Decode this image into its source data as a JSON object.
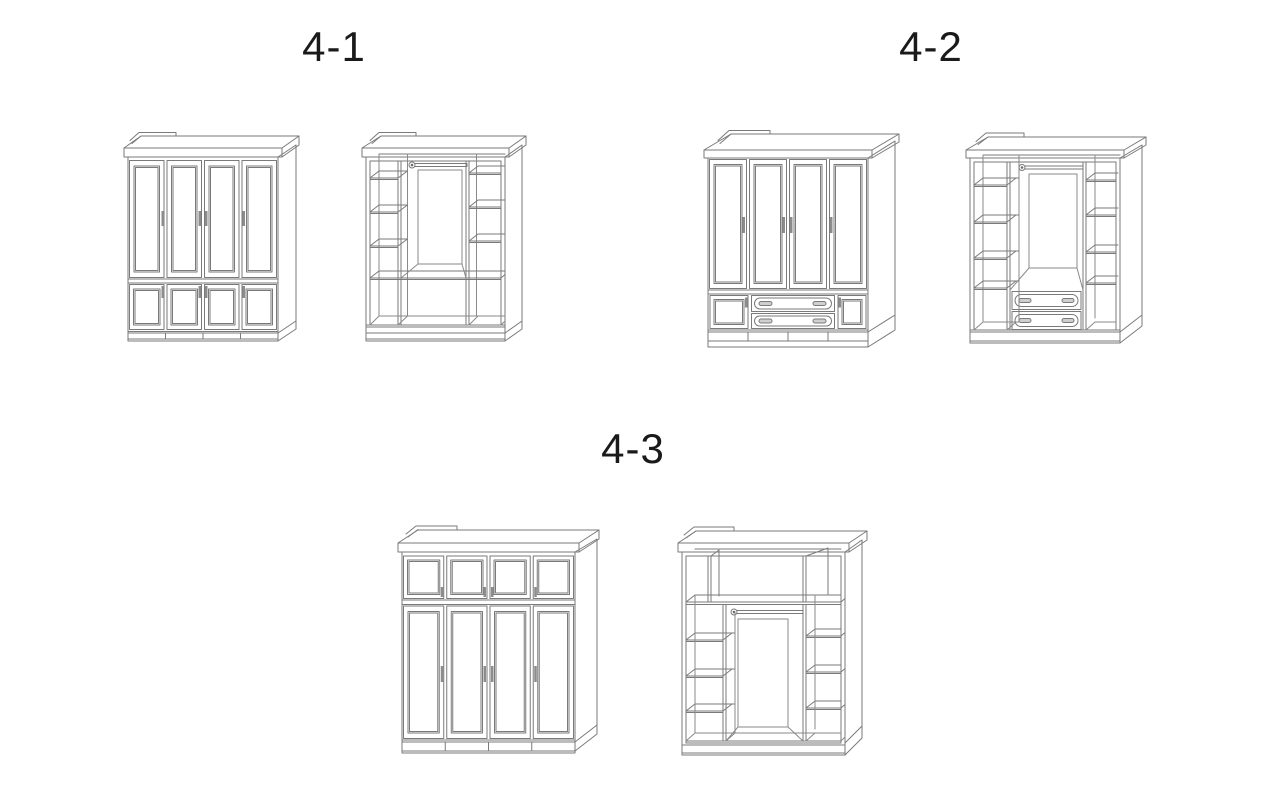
{
  "figure": {
    "background": "#ffffff",
    "line_color": "#7a7a7a",
    "label_color": "#1a1a1a"
  },
  "sections": [
    {
      "id": "4-1",
      "label": "4-1",
      "left_drawing": "closed wardrobe with four tall doors and four small lower doors",
      "right_drawing": "open carcass with side shelf columns, center hanging rod and bottom compartments"
    },
    {
      "id": "4-2",
      "label": "4-2",
      "left_drawing": "closed wardrobe with four tall doors, two small lower doors and two center drawers",
      "right_drawing": "open carcass with side shelf columns, center hanging rod and two center drawers"
    },
    {
      "id": "4-3",
      "label": "4-3",
      "left_drawing": "closed wardrobe with four top cabinet doors and four tall doors",
      "right_drawing": "open carcass with top shelf row, side shelf columns and center hanging rod"
    }
  ]
}
